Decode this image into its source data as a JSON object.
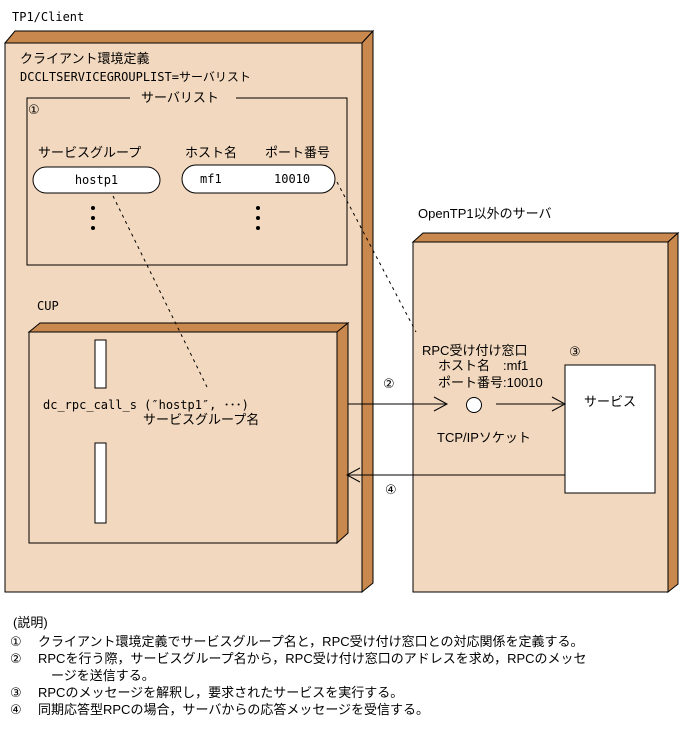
{
  "diagram": {
    "client": {
      "title": "TP1/Client",
      "env_def_line1": "クライアント環境定義",
      "env_def_line2": "DCCLTSERVICEGROUPLIST=サーバリスト",
      "server_list": {
        "title": "サーバリスト",
        "marker": "①",
        "columns": [
          "サービスグループ",
          "ホスト名",
          "ポート番号"
        ],
        "service_group_value": "hostp1",
        "host_value": "mf1",
        "port_value": "10010",
        "ellipsis_note": "vertical-dots"
      },
      "cup": {
        "label": "CUP",
        "call_line": "dc_rpc_call_s (″hostp1″, ･･･)",
        "call_annotation": "サービスグループ名"
      }
    },
    "server": {
      "title": "OpenTP1以外のサーバ",
      "rpc_window_label": "RPC受け付け窓口",
      "rpc_window_host": "ホスト名　:mf1",
      "rpc_window_port": "ポート番号:10010",
      "marker3": "③",
      "service_label": "サービス",
      "socket_label": "TCP/IPソケット"
    },
    "arrows": {
      "marker2": "②",
      "marker4": "④"
    }
  },
  "notes": {
    "heading": "(説明)",
    "items": [
      {
        "marker": "①",
        "text": "クライアント環境定義でサービスグループ名と，RPC受け付け窓口との対応関係を定義する。"
      },
      {
        "marker": "②",
        "text": "RPCを行う際，サービスグループ名から，RPC受け付け窓口のアドレスを求め，RPCのメッセ"
      },
      {
        "marker": "",
        "text": "ージを送信する。"
      },
      {
        "marker": "③",
        "text": "RPCのメッセージを解釈し，要求されたサービスを実行する。"
      },
      {
        "marker": "④",
        "text": "同期応答型RPCの場合，サーバからの応答メッセージを受信する。"
      }
    ]
  },
  "colors": {
    "box_face": "#F2D8BE",
    "box_side": "#C9894E",
    "outline": "#000000",
    "background": "#FFFFFF"
  }
}
